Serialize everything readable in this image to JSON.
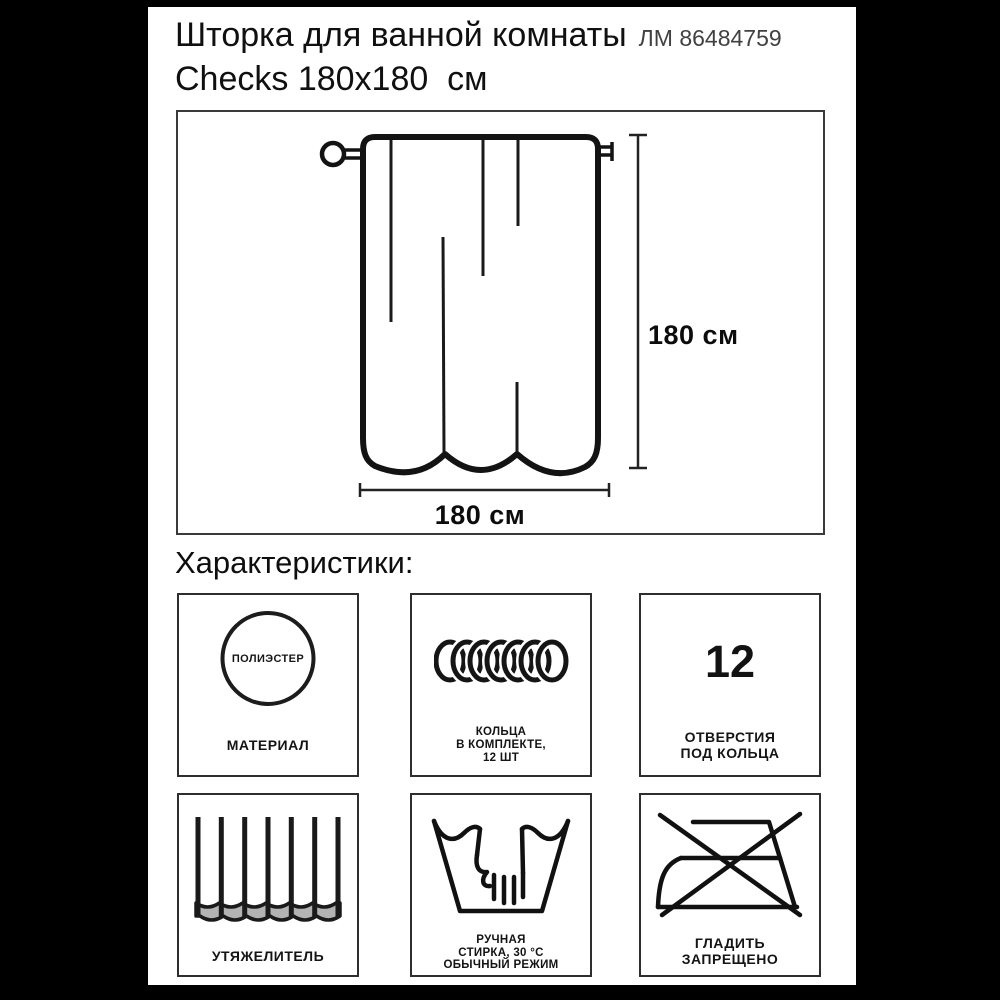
{
  "product": {
    "title": "Шторка для ванной комнаты",
    "sku": "ЛМ 86484759",
    "subtitle": "Checks 180x180  см"
  },
  "diagram": {
    "height_label": "180 см",
    "width_label": "180 см"
  },
  "characteristics": {
    "heading": "Характеристики:",
    "items": [
      {
        "name": "material",
        "icon": "polyester-circle-icon",
        "icon_text": "ПОЛИЭСТЕР",
        "lines": [
          "МАТЕРИАЛ"
        ]
      },
      {
        "name": "rings-included",
        "icon": "curtain-rings-icon",
        "lines": [
          "КОЛЬЦА",
          "В КОМПЛЕКТЕ,",
          "12 ШТ"
        ]
      },
      {
        "name": "ring-holes",
        "icon": "number-12",
        "icon_text": "12",
        "lines": [
          "ОТВЕРСТИЯ",
          "ПОД КОЛЬЦА"
        ]
      },
      {
        "name": "weighted-hem",
        "icon": "weighted-hem-icon",
        "lines": [
          "УТЯЖЕЛИТЕЛЬ"
        ]
      },
      {
        "name": "hand-wash",
        "icon": "hand-wash-icon",
        "lines": [
          "РУЧНАЯ",
          "СТИРКА, 30 °C",
          "ОБЫЧНЫЙ РЕЖИМ"
        ]
      },
      {
        "name": "no-iron",
        "icon": "no-iron-icon",
        "lines": [
          "ГЛАДИТЬ",
          "ЗАПРЕЩЕНО"
        ]
      }
    ]
  },
  "colors": {
    "background": "#000000",
    "card": "#ffffff",
    "ink": "#111111",
    "sku_gray": "#414141",
    "hem_gray": "#b3b3b3"
  }
}
